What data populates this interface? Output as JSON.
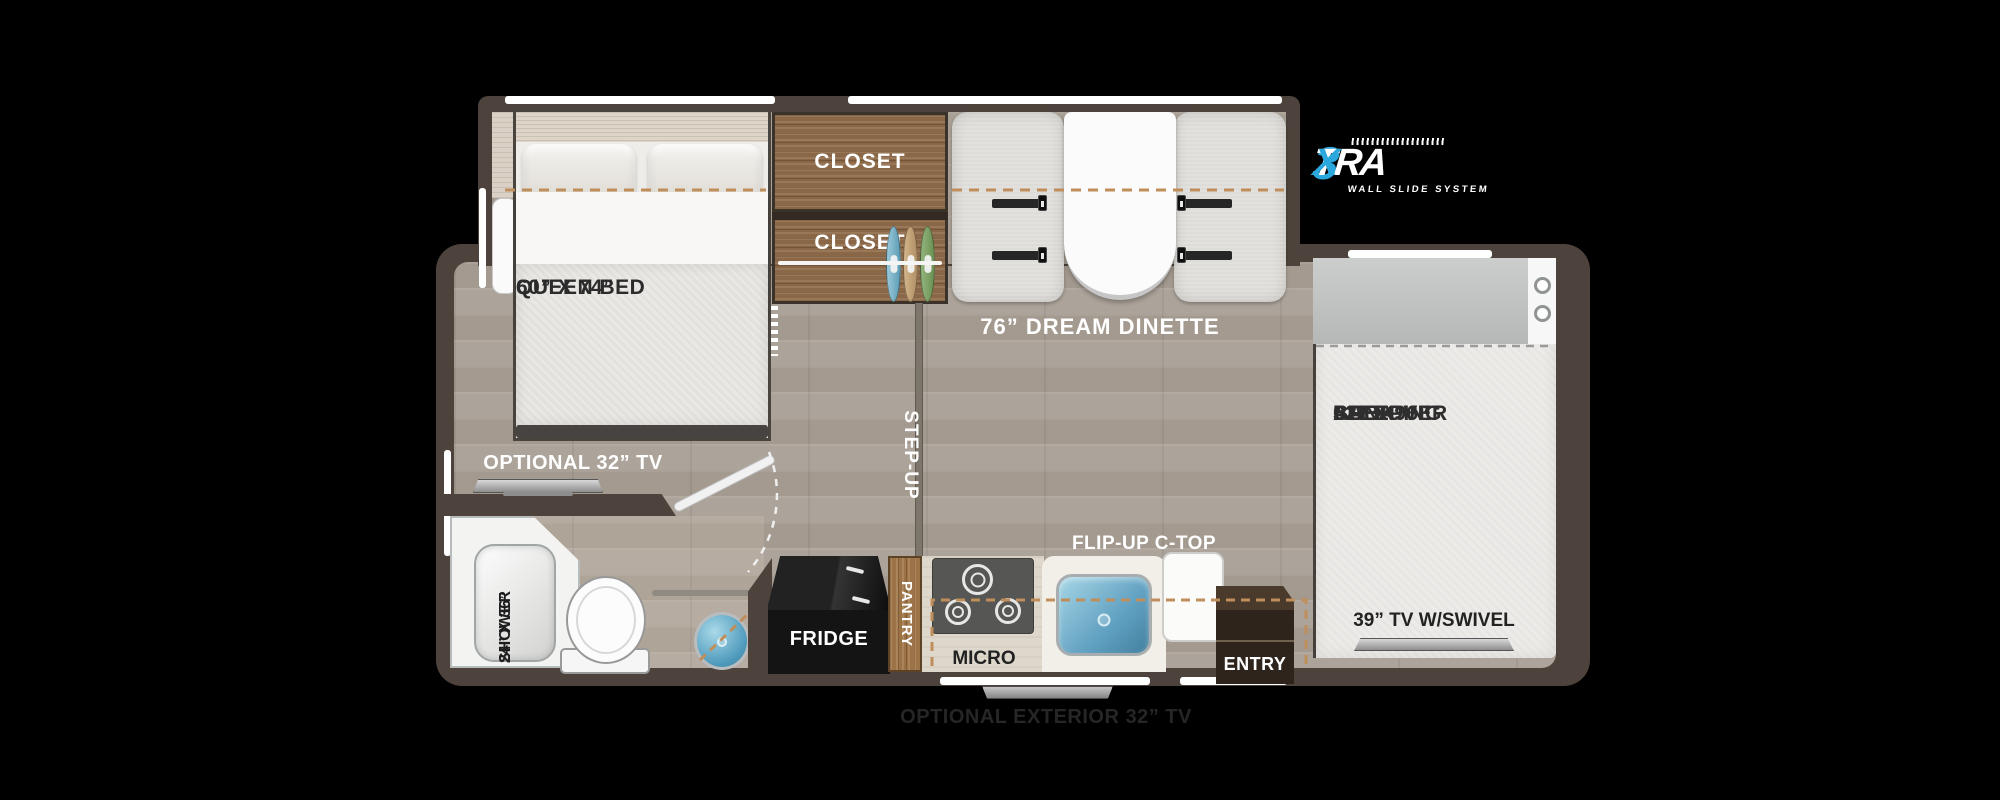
{
  "logo": {
    "three": "3",
    "tra": "TRA",
    "x": "X",
    "tagline": "WALL SLIDE SYSTEM",
    "accent_blue": "#2aa7dd"
  },
  "rooms": {
    "bedroom": {
      "closet_upper": "CLOSET",
      "closet_lower": "CLOSET",
      "queen_bed": [
        "QUEEN BED",
        "60” X 74”"
      ],
      "optional_tv": "OPTIONAL 32” TV"
    },
    "dinette": {
      "label": "76” DREAM DINETTE"
    },
    "hall": {
      "step_up": "STEP-UP"
    },
    "bath": {
      "shower": [
        "SHOWER",
        "24” X 36”"
      ]
    },
    "kitchen": {
      "fridge": "FRIDGE",
      "pantry": "PANTRY",
      "micro": "MICRO",
      "flip_up": "FLIP-UP C-TOP",
      "entry": "ENTRY"
    },
    "bunk": {
      "lines": [
        "CAB-OVER",
        "BUNK",
        "52” X 96”",
        "SLEEPING",
        "AREA"
      ],
      "tv": "39” TV W/SWIVEL"
    },
    "exterior": {
      "tv": "OPTIONAL EXTERIOR 32” TV"
    }
  },
  "colors": {
    "wall": "#4d433c",
    "floor": "#a89f95",
    "closet_wood": "#8a6847",
    "accent_dash": "#bf8e5a",
    "sink_blue": "#5f9fc0",
    "logo_blue": "#2aa7dd"
  }
}
